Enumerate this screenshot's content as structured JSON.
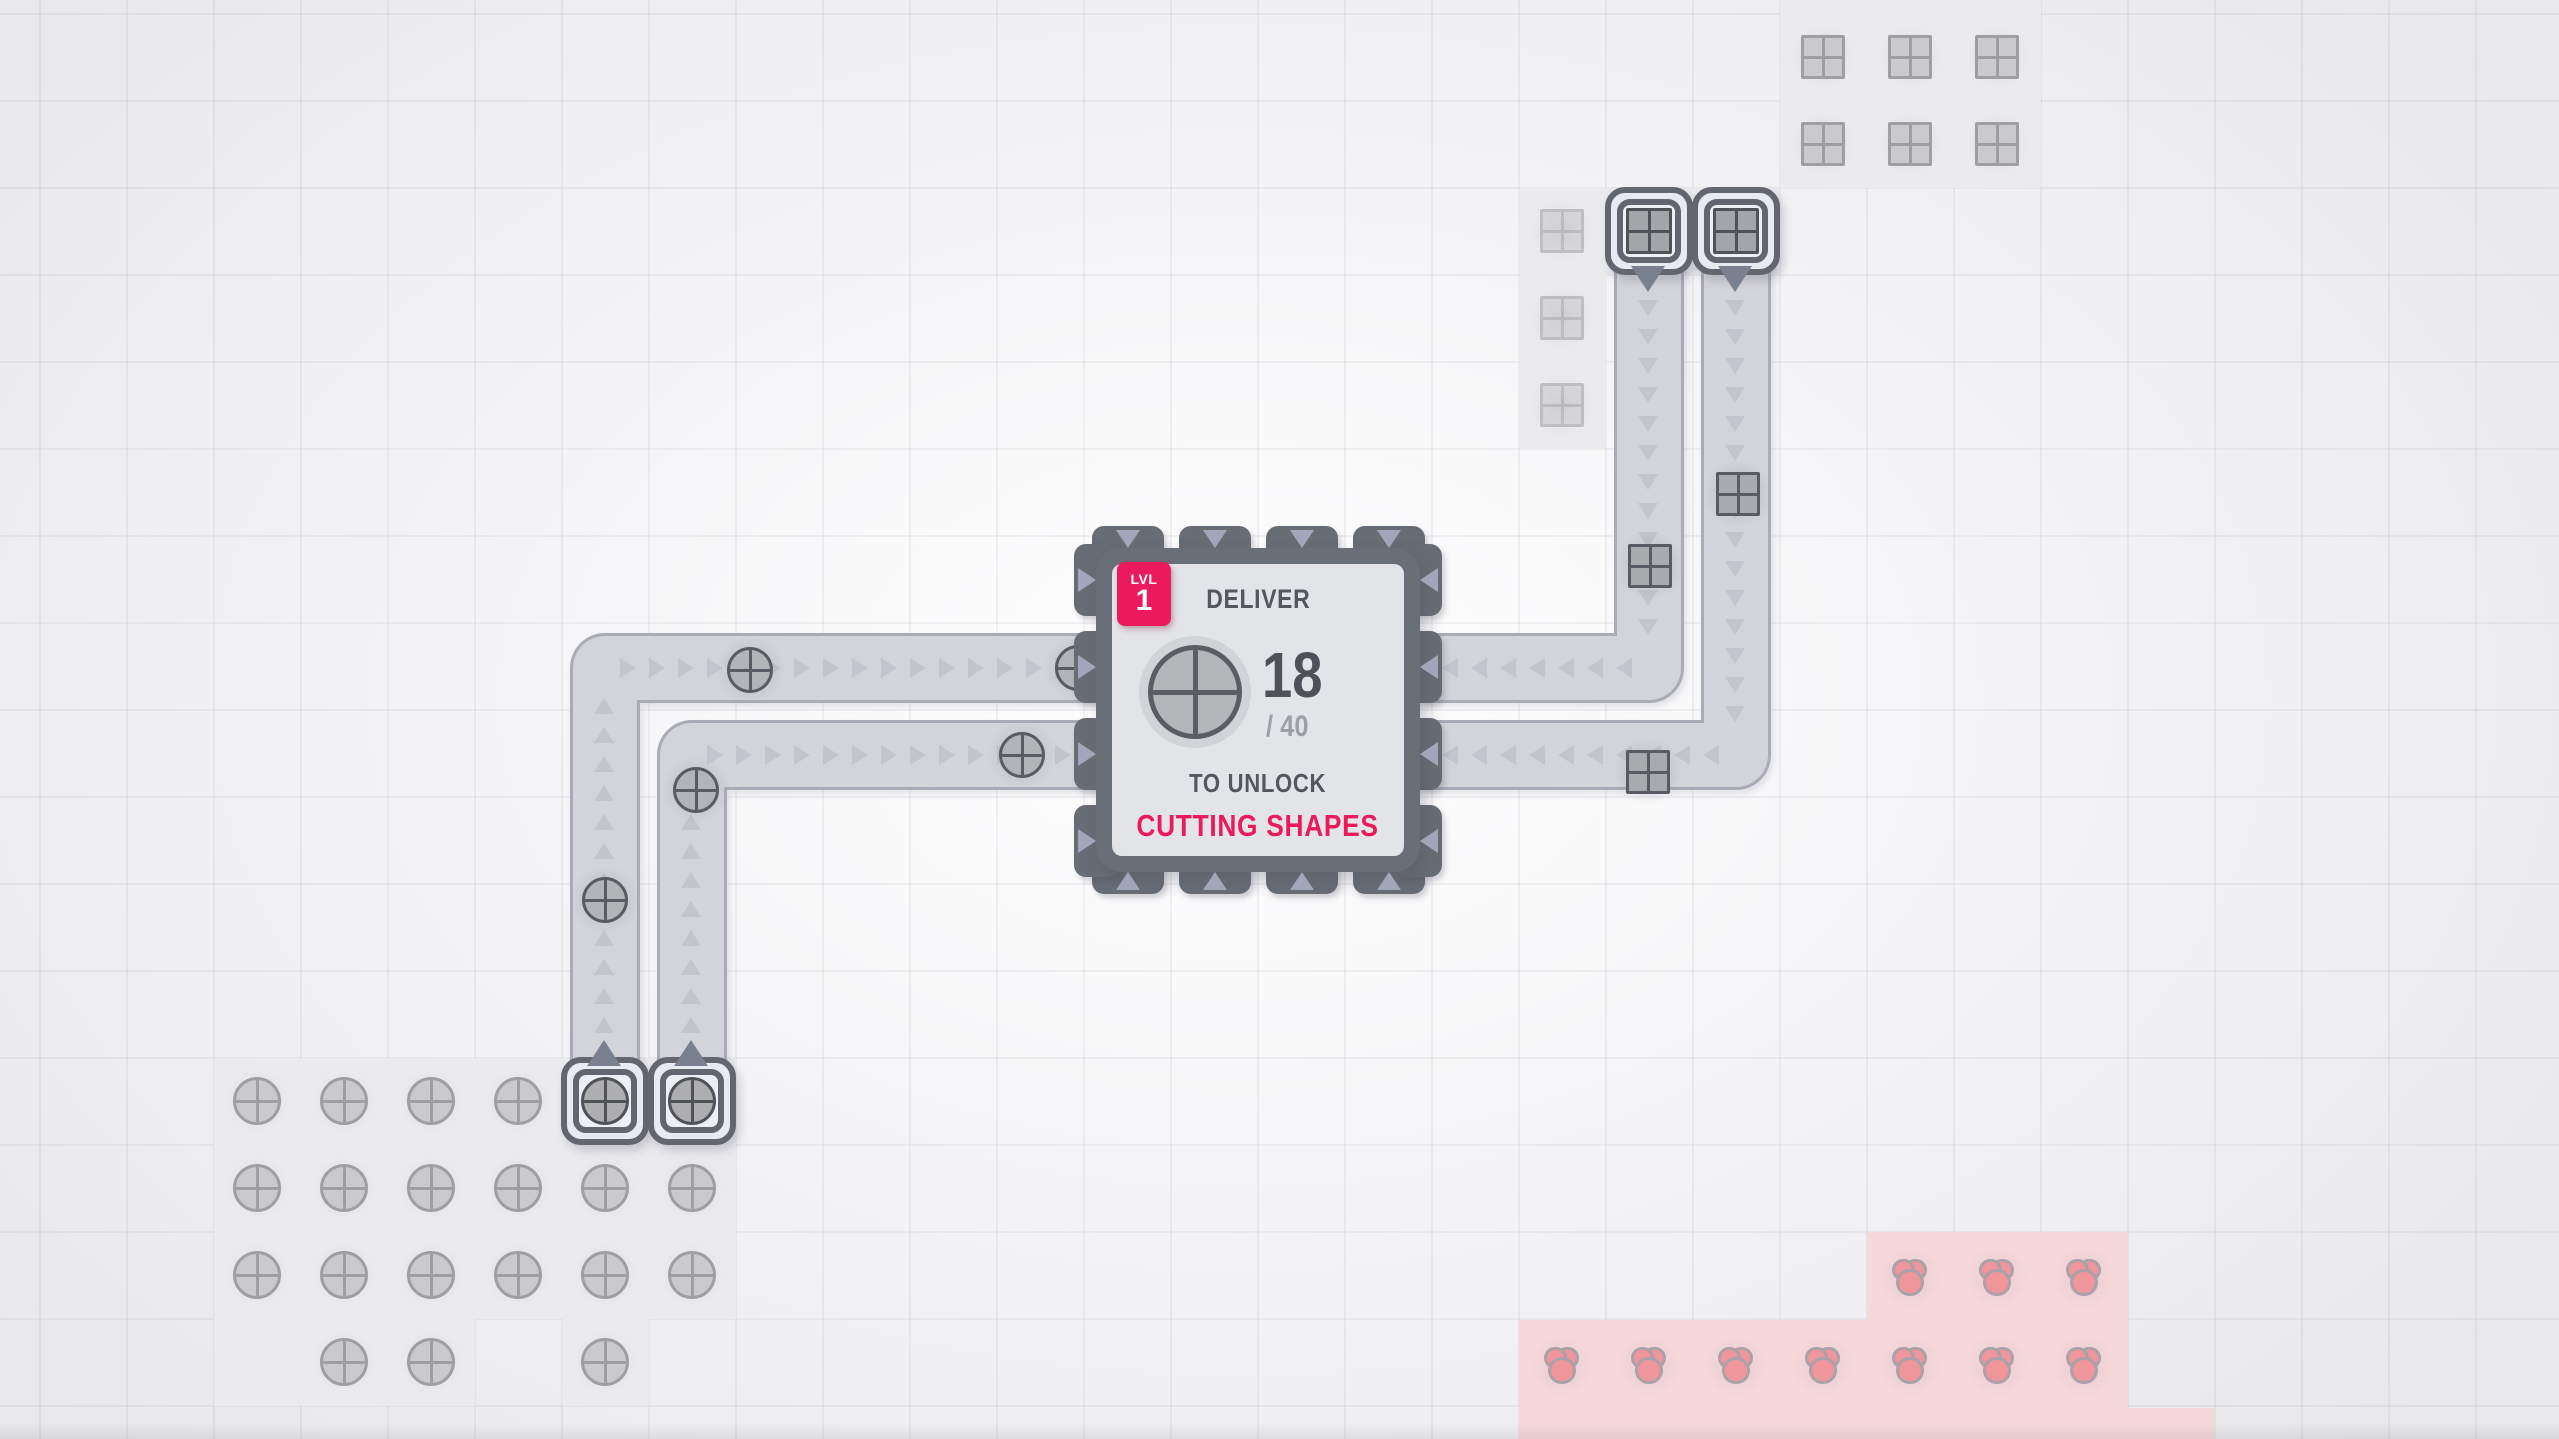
{
  "screen": {
    "width": 2559,
    "height": 1439
  },
  "hub": {
    "level_label": "LVL",
    "level": "1",
    "deliver_label": "DELIVER",
    "count": "18",
    "total": "/ 40",
    "unlock_label": "TO UNLOCK",
    "reward": "CUTTING SHAPES",
    "goal_shape": "circle-quad-shape"
  },
  "colors": {
    "accent": "#ea1a5c",
    "text_dark": "#53575e",
    "text_light": "#9ba0a8",
    "belt_fill": "#d3d4d9",
    "belt_edge": "#a9abb5",
    "belt_arrow": "#c3c5cd",
    "tab": "#686c74",
    "tab_arrow": "#a3a6bb",
    "hub_body": "#6a6e76",
    "hub_panel": "#e3e4e7",
    "patch_gray": "#ebebee",
    "patch_pink": "#f6d8da",
    "item_circle_fill": "#b3b4b7",
    "item_square_fill": "#a8aaae",
    "item_stroke": "#585b61",
    "deposit_fill": "#c8c8ca",
    "deposit_stroke": "#97989c",
    "miner_bg": "#e8eaf1",
    "miner_inner_bg": "#edeff5",
    "miner_border": "#63666e",
    "miner_arrow": "#7b8090",
    "red_fill": "#f0939a",
    "red_stroke": "#a89fa4"
  },
  "world": {
    "tile": 87,
    "grid_offset": {
      "x": 39,
      "y": 13
    },
    "patches": [
      {
        "kind": "gray",
        "x": 214,
        "y": 1058,
        "w": 522,
        "h": 261
      },
      {
        "kind": "gray",
        "x": 214,
        "y": 1319,
        "w": 261,
        "h": 87
      },
      {
        "kind": "gray",
        "x": 562,
        "y": 1319,
        "w": 87,
        "h": 87
      },
      {
        "kind": "gray",
        "x": 1780,
        "y": 0,
        "w": 261,
        "h": 188
      },
      {
        "kind": "gray",
        "x": 1519,
        "y": 188,
        "w": 87,
        "h": 261
      },
      {
        "kind": "gray",
        "x": 1606,
        "y": 188,
        "w": 174,
        "h": 87
      },
      {
        "kind": "pink",
        "x": 1867,
        "y": 1232,
        "w": 261,
        "h": 88
      },
      {
        "kind": "pink",
        "x": 1519,
        "y": 1320,
        "w": 609,
        "h": 88
      },
      {
        "kind": "pink",
        "x": 1519,
        "y": 1408,
        "w": 696,
        "h": 31
      }
    ],
    "deposits": [
      {
        "type": "circle",
        "x": 257,
        "y": 1101
      },
      {
        "type": "circle",
        "x": 344,
        "y": 1101
      },
      {
        "type": "circle",
        "x": 431,
        "y": 1101
      },
      {
        "type": "circle",
        "x": 518,
        "y": 1101
      },
      {
        "type": "circle",
        "x": 257,
        "y": 1188
      },
      {
        "type": "circle",
        "x": 344,
        "y": 1188
      },
      {
        "type": "circle",
        "x": 431,
        "y": 1188
      },
      {
        "type": "circle",
        "x": 518,
        "y": 1188
      },
      {
        "type": "circle",
        "x": 605,
        "y": 1188
      },
      {
        "type": "circle",
        "x": 692,
        "y": 1188
      },
      {
        "type": "circle",
        "x": 257,
        "y": 1275
      },
      {
        "type": "circle",
        "x": 344,
        "y": 1275
      },
      {
        "type": "circle",
        "x": 431,
        "y": 1275
      },
      {
        "type": "circle",
        "x": 518,
        "y": 1275
      },
      {
        "type": "circle",
        "x": 605,
        "y": 1275
      },
      {
        "type": "circle",
        "x": 692,
        "y": 1275
      },
      {
        "type": "circle",
        "x": 344,
        "y": 1362
      },
      {
        "type": "circle",
        "x": 431,
        "y": 1362
      },
      {
        "type": "circle",
        "x": 605,
        "y": 1362
      },
      {
        "type": "square",
        "x": 1562,
        "y": 231,
        "faint": true
      },
      {
        "type": "square",
        "x": 1562,
        "y": 318,
        "faint": true
      },
      {
        "type": "square",
        "x": 1562,
        "y": 405,
        "faint": true
      },
      {
        "type": "square",
        "x": 1823,
        "y": 57
      },
      {
        "type": "square",
        "x": 1910,
        "y": 57
      },
      {
        "type": "square",
        "x": 1997,
        "y": 57
      },
      {
        "type": "square",
        "x": 1823,
        "y": 144
      },
      {
        "type": "square",
        "x": 1910,
        "y": 144
      },
      {
        "type": "square",
        "x": 1997,
        "y": 144
      },
      {
        "type": "red",
        "x": 1910,
        "y": 1278
      },
      {
        "type": "red",
        "x": 1997,
        "y": 1278
      },
      {
        "type": "red",
        "x": 2084,
        "y": 1278
      },
      {
        "type": "red",
        "x": 1562,
        "y": 1366
      },
      {
        "type": "red",
        "x": 1649,
        "y": 1366
      },
      {
        "type": "red",
        "x": 1736,
        "y": 1366
      },
      {
        "type": "red",
        "x": 1823,
        "y": 1366
      },
      {
        "type": "red",
        "x": 1910,
        "y": 1366
      },
      {
        "type": "red",
        "x": 1997,
        "y": 1366
      },
      {
        "type": "red",
        "x": 2084,
        "y": 1366
      }
    ],
    "belts": [
      {
        "points": [
          [
            605,
            1078
          ],
          [
            605,
            668
          ],
          [
            1122,
            668
          ]
        ]
      },
      {
        "points": [
          [
            692,
            1078
          ],
          [
            692,
            755
          ],
          [
            1122,
            755
          ]
        ]
      },
      {
        "points": [
          [
            1649,
            255
          ],
          [
            1649,
            668
          ],
          [
            1420,
            668
          ]
        ]
      },
      {
        "points": [
          [
            1736,
            255
          ],
          [
            1736,
            755
          ],
          [
            1420,
            755
          ]
        ]
      }
    ],
    "items": [
      {
        "type": "circle",
        "x": 605,
        "y": 900
      },
      {
        "type": "circle",
        "x": 696,
        "y": 790
      },
      {
        "type": "circle",
        "x": 750,
        "y": 670
      },
      {
        "type": "circle",
        "x": 1022,
        "y": 755
      },
      {
        "type": "circle",
        "x": 1078,
        "y": 668
      },
      {
        "type": "square",
        "x": 1650,
        "y": 566
      },
      {
        "type": "square",
        "x": 1738,
        "y": 494
      },
      {
        "type": "square",
        "x": 1648,
        "y": 772
      }
    ],
    "miners": [
      {
        "x": 605,
        "y": 1101,
        "dir": "up",
        "resource": "circle"
      },
      {
        "x": 692,
        "y": 1101,
        "dir": "up",
        "resource": "circle"
      },
      {
        "x": 1649,
        "y": 231,
        "dir": "down",
        "resource": "square"
      },
      {
        "x": 1736,
        "y": 231,
        "dir": "down",
        "resource": "square"
      }
    ],
    "hub_geom": {
      "body": {
        "x": 1096,
        "y": 548,
        "w": 324,
        "h": 324
      },
      "tab_centers_x": [
        1128,
        1215,
        1302,
        1389
      ],
      "tab_centers_y": [
        580,
        667,
        754,
        841
      ]
    }
  }
}
